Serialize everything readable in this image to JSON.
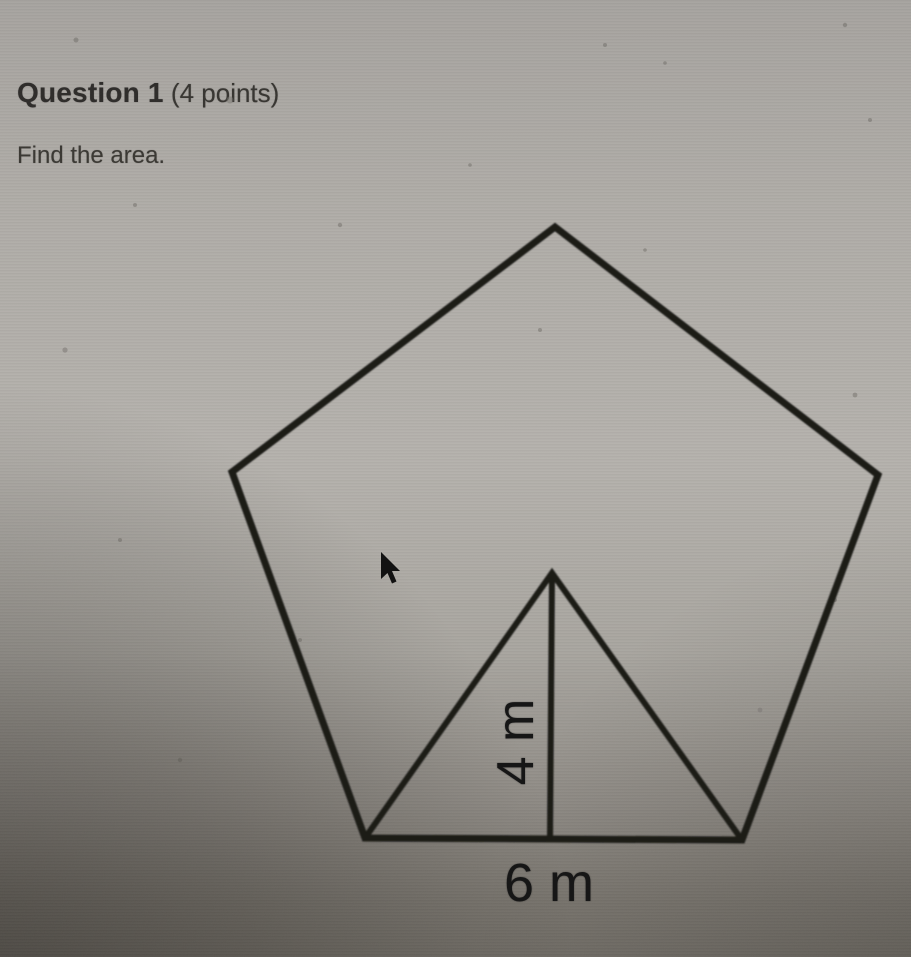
{
  "question": {
    "number_label": "Question 1",
    "points_label": " (4 points)",
    "prompt": "Find the area."
  },
  "figure": {
    "shape": "regular pentagon with inscribed triangle showing apothem",
    "apothem_label": "4 m",
    "side_label": "6 m",
    "apothem_value": 4,
    "side_value": 6,
    "unit": "m"
  },
  "colors": {
    "background_light": "#b6b3ae",
    "background_dark_corner": "#6e6a64",
    "line_color": "#1a1a18",
    "text_color": "#2c2a28"
  }
}
